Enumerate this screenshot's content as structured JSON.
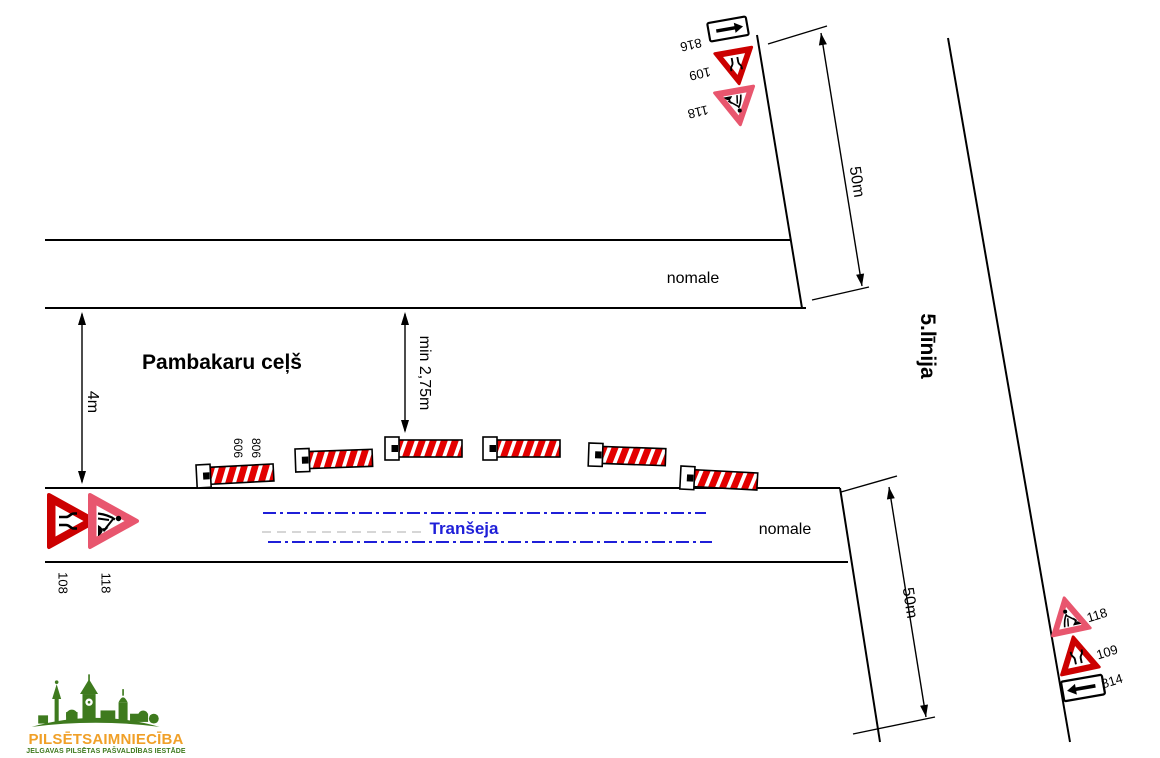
{
  "scheme": {
    "type": "road-works traffic organization scheme"
  },
  "roads": {
    "horizontal_name": "Pambakaru ceļš",
    "diagonal_name": "5.līnija",
    "shoulder_label_top": "nomale",
    "shoulder_label_bottom": "nomale"
  },
  "trench": {
    "label": "Tranšeja",
    "line_color": "#1f1fd8"
  },
  "dimensions": {
    "road_width": "4m",
    "min_clearance": "min 2,75m",
    "distance_top": "50m",
    "distance_bottom": "50m"
  },
  "barriers": {
    "board_label": "606",
    "lamp_label": "806",
    "count": 6,
    "stripe_color": "#e30000"
  },
  "signs": {
    "top_group": [
      {
        "id": "816",
        "type": "arrow-left-plate"
      },
      {
        "id": "109",
        "type": "road-narrows-warning"
      },
      {
        "id": "118",
        "type": "road-works-warning"
      }
    ],
    "left_group": [
      {
        "id": "108",
        "type": "road-narrows-warning"
      },
      {
        "id": "118",
        "type": "road-works-warning"
      }
    ],
    "right_group": [
      {
        "id": "118",
        "type": "road-works-warning"
      },
      {
        "id": "109",
        "type": "road-narrows-warning"
      },
      {
        "id": "814",
        "type": "arrow-left-plate"
      }
    ]
  },
  "colors": {
    "warning_red": "#cc0000",
    "works_pink": "#e8566e",
    "trench_blue": "#1f1fd8",
    "logo_green": "#3E7A1E",
    "logo_orange": "#F0A028"
  },
  "logo": {
    "title": "PILSĒTSAIMNIECĪBA",
    "subtitle": "JELGAVAS PILSĒTAS PAŠVALDĪBAS IESTĀDE"
  }
}
